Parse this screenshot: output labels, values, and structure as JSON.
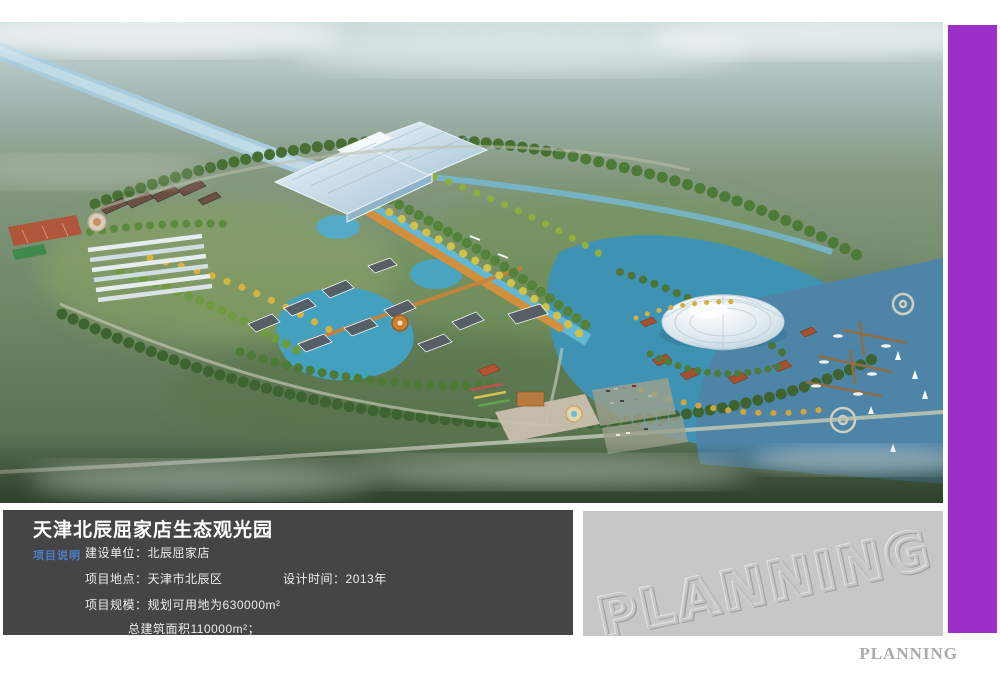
{
  "info_panel": {
    "title": "天津北辰屈家店生态观光园",
    "section_label": "项目说明",
    "row1_label": "建设单位：",
    "row1_value": "北辰屈家店",
    "row2_label": "项目地点：",
    "row2_value": "天津市北辰区",
    "row2b_label": "设计时间：",
    "row2b_value": "2013年",
    "row3_label": "项目规模：",
    "row3_value": "规划可用地为630000m²",
    "row4_value": "总建筑面积110000m²；"
  },
  "watermark_panel": {
    "text": "PLANNING"
  },
  "footer": {
    "brand": "PLANNING"
  },
  "aerial_scene": {
    "description": "misty aerial rendering of Qujiadian eco-tourism park",
    "features": [
      "diagonal-river",
      "glass-exhibition-hall",
      "greenhouse-rows",
      "sports-courts",
      "village-buildings",
      "central-canal-with-beach",
      "lakes",
      "white-dome",
      "marina-piers",
      "sailboats",
      "entrance-plaza",
      "parking-lot",
      "tree-belts",
      "fog"
    ]
  },
  "colors": {
    "accent_purple": "#9b2fc8",
    "info_panel_bg": "#454545",
    "section_label_blue": "#4d7cc9",
    "watermark_panel_bg": "#c7c7c7",
    "brand_gray": "#a9a9a9"
  }
}
